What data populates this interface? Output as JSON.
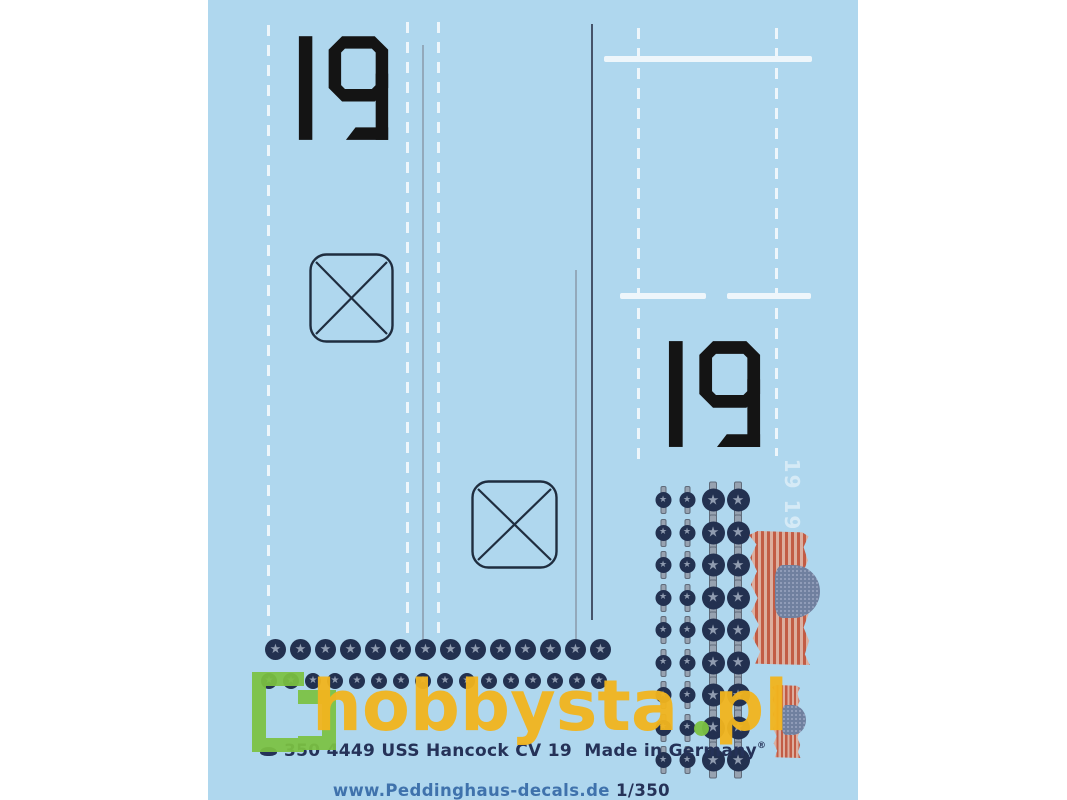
{
  "product_sheet": {
    "hull_number_left": "19",
    "hull_number_right": "19",
    "ghost_numbers": "19 19"
  },
  "watermark": {
    "brand": "hobbysta",
    "tld": "pl"
  },
  "footer": {
    "line1": "350 4449 USS Hancock CV 19  Made in Germany",
    "registered_mark": "®",
    "website": "www.Peddinghaus-decals.de ",
    "scale": "1/350"
  },
  "decal_elements": {
    "star_row_large": {
      "count": 14
    },
    "star_row_small": {
      "count": 16
    },
    "insignia_grid": {
      "rows": 9,
      "columns": [
        "small",
        "small",
        "large",
        "large"
      ]
    },
    "elevator_boxes": 2,
    "flags": {
      "large": 1,
      "small": 1
    }
  },
  "colors": {
    "sheet_blue": "#afd7ee",
    "marking_white": "#eef6fb",
    "numeral_black": "#141414",
    "insignia_navy": "#233150",
    "insignia_gray": "#909cb0",
    "flag_red": "#c25c45",
    "flag_canton": "#70809f",
    "watermark_green": "#7cc242",
    "watermark_yellow": "#f2b51e",
    "footer_navy": "#253258",
    "footer_blue": "#3f72ac"
  }
}
